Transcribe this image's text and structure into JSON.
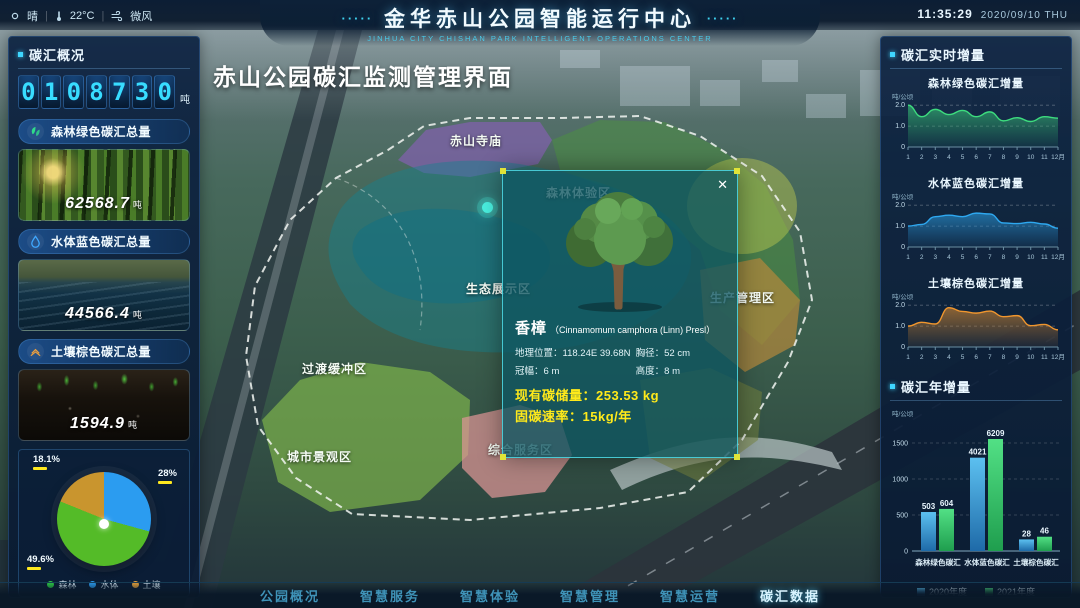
{
  "topbar": {
    "weather": {
      "condition": "晴",
      "temperature": "22°C",
      "wind": "微风"
    },
    "decor_left": "·····",
    "title": "金华赤山公园智能运行中心",
    "decor_right": "·····",
    "subtitle": "Jinhua City Chishan Park Intelligent Operations Center",
    "time": "11:35:29",
    "date": "2020/09/10",
    "weekday": "THU"
  },
  "overlay_title": "赤山公园碳汇监测管理界面",
  "left_panel": {
    "section_title": "碳汇概况",
    "counter": {
      "digits": [
        "0",
        "1",
        "0",
        "8",
        "7",
        "3",
        "0"
      ],
      "unit": "吨"
    },
    "cards": [
      {
        "title": "森林绿色碳汇总量",
        "value": "62568.7",
        "unit": "吨",
        "icon": "forest-leaves-icon",
        "accent": "#2fdc8a"
      },
      {
        "title": "水体蓝色碳汇总量",
        "value": "44566.4",
        "unit": "吨",
        "icon": "water-drop-icon",
        "accent": "#3fa8ff"
      },
      {
        "title": "土壤棕色碳汇总量",
        "value": "1594.9",
        "unit": "吨",
        "icon": "soil-layers-icon",
        "accent": "#f0a03c"
      }
    ],
    "pie_chart": {
      "type": "pie",
      "slices": [
        {
          "label": "水体",
          "pct_label": "28%",
          "value": 28,
          "color": "#2b9cf0"
        },
        {
          "label": "森林",
          "pct_label": "49.6%",
          "value": 49.6,
          "color": "#54bb28"
        },
        {
          "label": "土壤",
          "pct_label": "18.1%",
          "value": 18.1,
          "color": "#c9952e"
        }
      ],
      "legend": [
        {
          "label": "森林",
          "color": "#2ecc47"
        },
        {
          "label": "水体",
          "color": "#2b9cf0"
        },
        {
          "label": "土壤",
          "color": "#e8a33d"
        }
      ]
    }
  },
  "map": {
    "zone_labels": [
      {
        "text": "赤山寺庙",
        "x": 450,
        "y": 132
      },
      {
        "text": "森林体验区",
        "x": 546,
        "y": 184
      },
      {
        "text": "生态展示区",
        "x": 466,
        "y": 280
      },
      {
        "text": "过渡缓冲区",
        "x": 302,
        "y": 360
      },
      {
        "text": "城市景观区",
        "x": 287,
        "y": 448
      },
      {
        "text": "综合服务区",
        "x": 488,
        "y": 441
      },
      {
        "text": "生产管理区",
        "x": 710,
        "y": 289
      }
    ],
    "popup": {
      "close": "✕",
      "species": "香樟",
      "latin": "（Cinnamomum camphora (Linn) Presl）",
      "fields": [
        {
          "label": "地理位置：",
          "value": "118.24E 39.68N"
        },
        {
          "label": "胸径：",
          "value": "52 cm"
        },
        {
          "label": "冠幅：",
          "value": "6 m"
        },
        {
          "label": "高度：",
          "value": "8 m"
        }
      ],
      "storage_label": "现有碳储量：",
      "storage_value": "253.53 kg",
      "rate_label": "固碳速率：",
      "rate_value": "15kg/年"
    }
  },
  "right_panel": {
    "realtime_section_title": "碳汇实时增量",
    "months": [
      "1",
      "2",
      "3",
      "4",
      "5",
      "6",
      "7",
      "8",
      "9",
      "10",
      "11",
      "12月"
    ],
    "realtime_charts": [
      {
        "type": "area",
        "title": "森林绿色碳汇增量",
        "unit": "吨/公顷",
        "yticks": [
          "2.0",
          "1.0",
          "0"
        ],
        "color": "#3ddc7e",
        "values": [
          2.0,
          1.45,
          1.8,
          1.55,
          1.75,
          1.45,
          1.68,
          1.25,
          1.4,
          1.22,
          1.45,
          1.38
        ]
      },
      {
        "type": "area",
        "title": "水体蓝色碳汇增量",
        "unit": "吨/公顷",
        "yticks": [
          "2.0",
          "1.0",
          "0"
        ],
        "color": "#2ea8f0",
        "values": [
          1.0,
          1.08,
          1.45,
          1.52,
          1.45,
          1.62,
          1.58,
          1.15,
          1.12,
          1.18,
          1.1,
          0.9
        ]
      },
      {
        "type": "area",
        "title": "土壤棕色碳汇增量",
        "unit": "吨/公顷",
        "yticks": [
          "2.0",
          "1.0",
          "0"
        ],
        "color": "#f0962e",
        "values": [
          1.0,
          1.18,
          1.1,
          1.88,
          1.7,
          1.62,
          1.72,
          1.45,
          1.5,
          1.02,
          1.08,
          0.82
        ]
      }
    ],
    "annual_section_title": "碳汇年增量",
    "annual_chart": {
      "type": "bar",
      "unit": "吨/公顷",
      "yticks": [
        0,
        500,
        1000,
        1500
      ],
      "categories": [
        "森林绿色碳汇",
        "水体蓝色碳汇",
        "土壤棕色碳汇"
      ],
      "series": [
        {
          "name": "2020年度",
          "color_top": "#5cc0f0",
          "color_bottom": "#1e6aa8",
          "values": [
            503,
            4021,
            28
          ]
        },
        {
          "name": "2021年度",
          "color_top": "#52e085",
          "color_bottom": "#1f9e4e",
          "values": [
            604,
            6209,
            46
          ]
        }
      ]
    }
  },
  "bottom_nav": {
    "items": [
      "公园概况",
      "智慧服务",
      "智慧体验",
      "智慧管理",
      "智慧运营",
      "碳汇数据"
    ],
    "active_index": 5
  }
}
